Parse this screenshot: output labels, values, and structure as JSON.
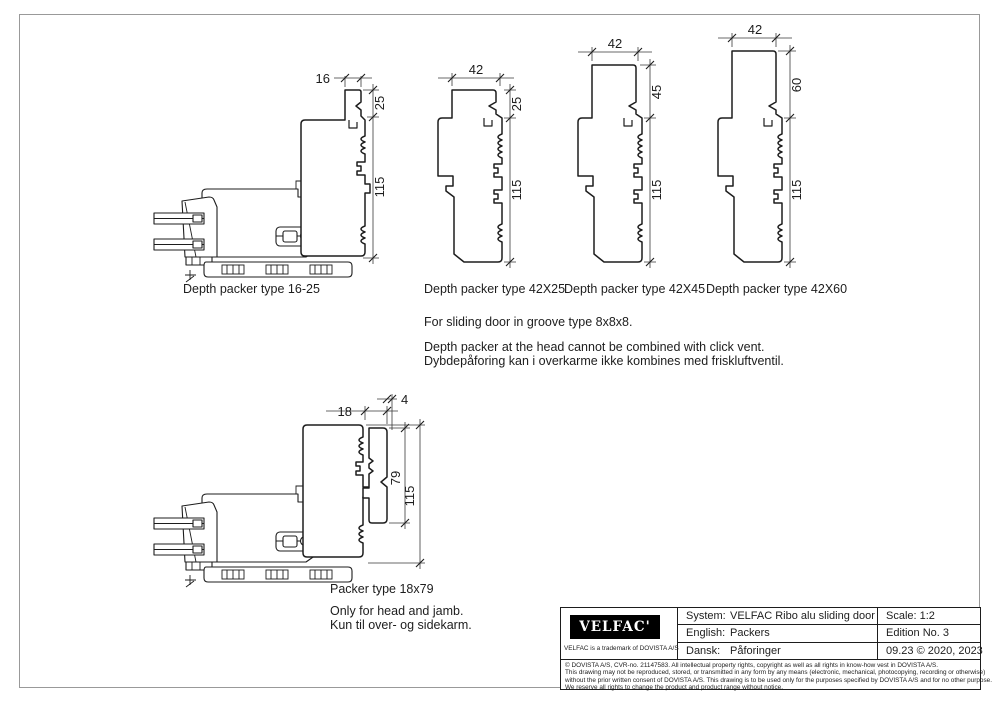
{
  "page": {
    "bg": "#ffffff",
    "line_color": "#1d1d1d",
    "border_color": "#999999"
  },
  "drawings": {
    "d1": {
      "label": "Depth packer type 16-25",
      "dim_width": "16",
      "dim_top": "25",
      "dim_total": "115"
    },
    "d2": {
      "label": "Depth packer type 42X25",
      "dim_width": "42",
      "dim_top": "25",
      "dim_total": "115"
    },
    "d3": {
      "label": "Depth packer type 42X45",
      "dim_width": "42",
      "dim_top": "45",
      "dim_total": "115"
    },
    "d4": {
      "label": "Depth packer type 42X60",
      "dim_width": "42",
      "dim_top": "60",
      "dim_total": "115"
    },
    "d5": {
      "label": "Packer type 18x79",
      "dim_width": "18",
      "dim_offset": "4",
      "dim_height": "79",
      "dim_total": "115",
      "note_en": "Only for head and jamb.",
      "note_da": "Kun til over- og sidekarm."
    }
  },
  "notes": {
    "groove": "For sliding door in groove type 8x8x8.",
    "warning_en": "Depth packer at the head cannot be combined with click vent.",
    "warning_da": "Dybdepåforing kan i overkarme ikke kombines med friskluftventil."
  },
  "title_block": {
    "logo_text": "VELFAC'",
    "logo_sub": "VELFAC is a trademark of DOVISTA A/S",
    "rows": [
      {
        "label": "System:",
        "value": "VELFAC Ribo alu sliding door"
      },
      {
        "label": "English:",
        "value": "Packers"
      },
      {
        "label": "Dansk:",
        "value": "Påforinger"
      }
    ],
    "scale": "Scale: 1:2",
    "edition": "Edition No. 3",
    "date": "09.23 © 2020, 2023",
    "legal": [
      "© DOVISTA A/S, CVR-no. 21147583. All intellectual property rights, copyright as well as all rights in know-how vest in DOVISTA A/S.",
      "This drawing may not be reproduced, stored, or transmitted in any form by any means (electronic, mechanical, photocopying, recording or otherwise)",
      "without the prior written consent of DOVISTA A/S. This drawing is to be used only for the purposes specified by DOVISTA A/S and for no other purpose.",
      "We reserve all rights to change the product and product range without notice."
    ]
  }
}
